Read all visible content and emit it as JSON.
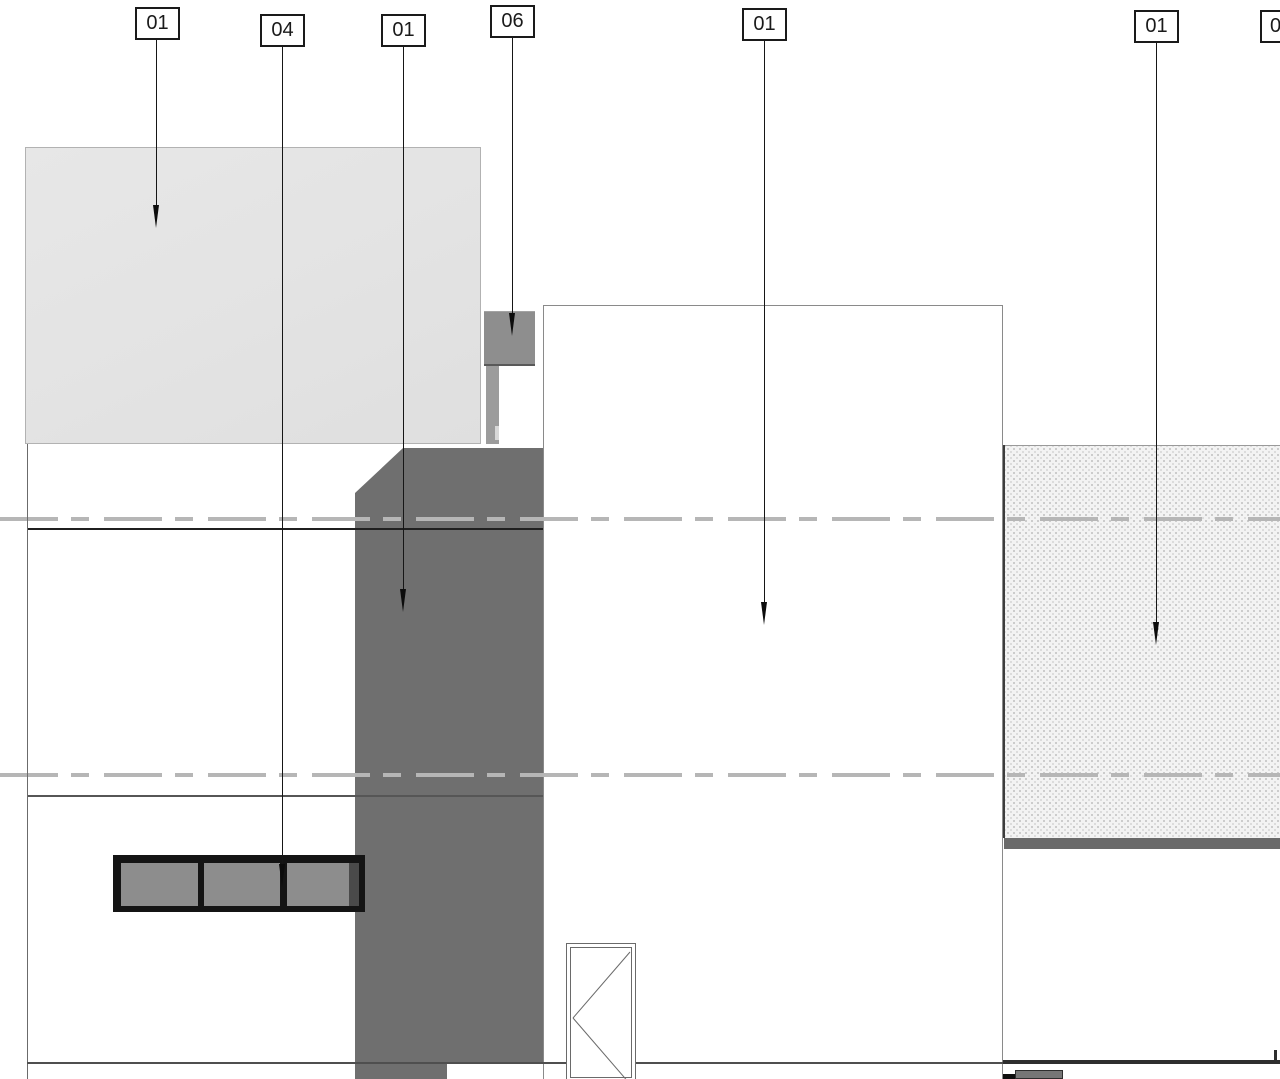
{
  "drawing": {
    "type": "architectural-elevation-detail",
    "colors": {
      "paper": "#ffffff",
      "light_block": "#e3e3e3",
      "column": "#6f6f6f",
      "block06": "#8e8e8e",
      "pane": "#8d8d8d",
      "frame": "#141414",
      "hatch_base": "#f3f3f3",
      "hatch_dot": "#c9c9c9",
      "dash_line": "#b6b6b6",
      "line_dark": "#1f1f1f",
      "line_mid": "#565656",
      "ground": "#2e2e2e",
      "outline": "#8a8a8a"
    },
    "callouts": [
      {
        "label": "01",
        "box_x": 135,
        "box_y": 7,
        "line_x": 156,
        "tip_y": 228
      },
      {
        "label": "04",
        "box_x": 260,
        "box_y": 14,
        "line_x": 282,
        "tip_y": 887
      },
      {
        "label": "01",
        "box_x": 381,
        "box_y": 14,
        "line_x": 403,
        "tip_y": 612
      },
      {
        "label": "06",
        "box_x": 490,
        "box_y": 5,
        "line_x": 512,
        "tip_y": 336
      },
      {
        "label": "01",
        "box_x": 742,
        "box_y": 8,
        "line_x": 764,
        "tip_y": 625
      },
      {
        "label": "01",
        "box_x": 1134,
        "box_y": 10,
        "line_x": 1156,
        "tip_y": 645
      },
      {
        "label": "0",
        "box_x": 1260,
        "box_y": 10,
        "line_x": null,
        "tip_y": null,
        "partial": true
      }
    ],
    "window": {
      "pane_count": 3,
      "panes": [
        {
          "x": 8,
          "w": 77
        },
        {
          "x": 91,
          "w": 76
        },
        {
          "x": 174,
          "w": 62
        }
      ]
    }
  }
}
